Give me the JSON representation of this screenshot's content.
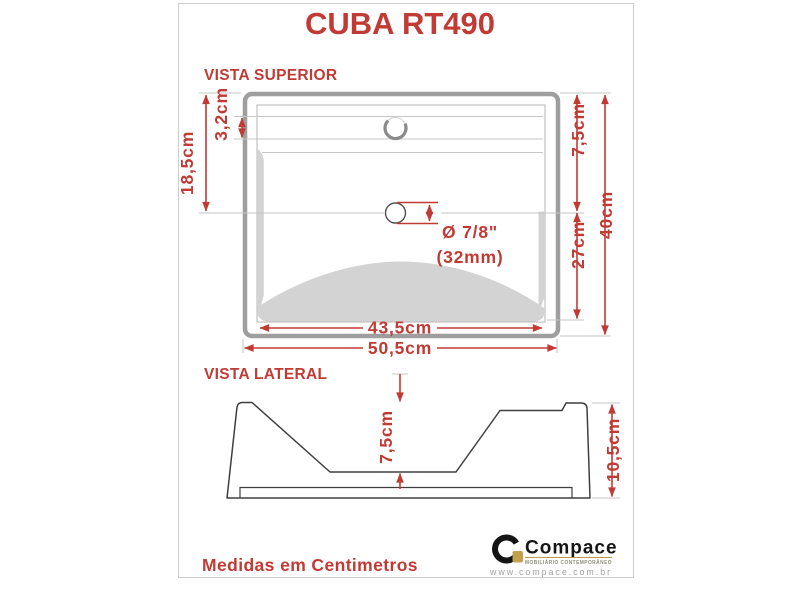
{
  "title": "CUBA RT490",
  "top_view": {
    "label": "VISTA SUPERIOR",
    "dim_left_depth": "18,5cm",
    "dim_faucet_hole": "3,2cm",
    "dim_right_back": "7,5cm",
    "dim_right_bowl": "27cm",
    "dim_right_total": "40cm",
    "dim_inner_width": "43,5cm",
    "dim_outer_width": "50,5cm",
    "drain_dia_inches": "Ø 7/8\"",
    "drain_dia_mm": "(32mm)"
  },
  "side_view": {
    "label": "VISTA LATERAL",
    "dim_bowl_depth": "7,5cm",
    "dim_total_height": "10,5cm"
  },
  "footer": {
    "note": "Medidas em Centimetros"
  },
  "brand": {
    "name": "Compace",
    "tagline": "MOBILIÁRIO CONTEMPORÂNEO",
    "website": "www.compace.com.br"
  },
  "colors": {
    "accent_red": "#c23a34",
    "outline_gray": "#9e9e9e",
    "shade_gray": "#d3d3d3",
    "brand_gold": "#c2a14b"
  }
}
